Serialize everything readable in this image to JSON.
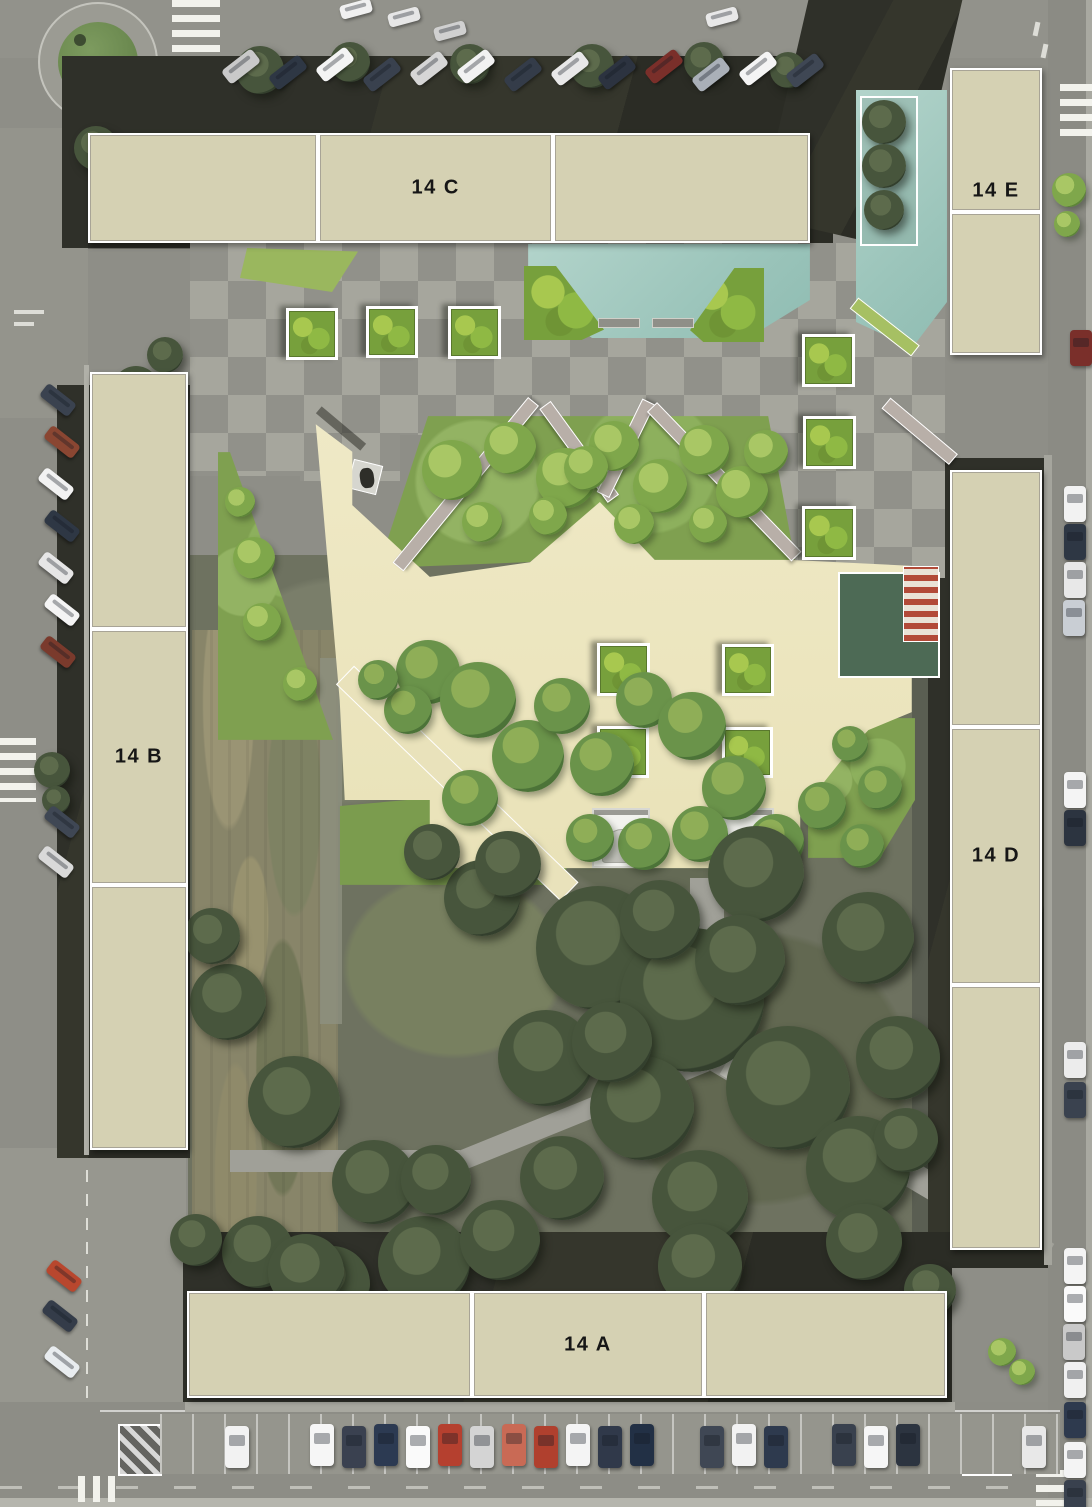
{
  "meta": {
    "canvas_width": 1092,
    "canvas_height": 1507
  },
  "palette": {
    "street": "#8e8e87",
    "roof_dark": "#32332b",
    "block_fill": "#d5d1b3",
    "block_border": "#ffffff",
    "block_label_color": "#161616",
    "plaza_cream": "#ece5bd",
    "pool_teal": "#a3cac1",
    "lawn_bright": "#85a453",
    "checker_light": "#a6a69d",
    "checker_dark": "#91918a",
    "pergola": "#b8afa8",
    "awning_red": "#b24a38",
    "flat_roof_green": "#4d6a55",
    "path_light": "#a0a098",
    "tree_dark": "#47553c",
    "white_structure": "#f2f2ee"
  },
  "buildings": [
    {
      "id": "14C",
      "label": "14 C",
      "x": 88,
      "y": 133,
      "w": 722,
      "h": 110,
      "orientation": "h",
      "dividers": [
        0.319,
        0.644
      ],
      "label_segment": 1
    },
    {
      "id": "14E",
      "label": "14 E",
      "x": 950,
      "y": 68,
      "w": 92,
      "h": 287,
      "orientation": "v",
      "dividers": [
        0.5
      ],
      "label_segment": 0,
      "label_pos": [
        0.5,
        0.43
      ]
    },
    {
      "id": "14B",
      "label": "14 B",
      "x": 90,
      "y": 372,
      "w": 98,
      "h": 778,
      "orientation": "v",
      "dividers": [
        0.33,
        0.66
      ],
      "label_segment": 1
    },
    {
      "id": "14D",
      "label": "14 D",
      "x": 950,
      "y": 470,
      "w": 92,
      "h": 780,
      "orientation": "v",
      "dividers": [
        0.33,
        0.66
      ],
      "label_segment": 1
    },
    {
      "id": "14A",
      "label": "14 A",
      "x": 187,
      "y": 1291,
      "w": 760,
      "h": 107,
      "orientation": "h",
      "dividers": [
        0.375,
        0.68
      ],
      "label_segment": 1
    }
  ],
  "planters": [
    [
      286,
      308,
      46
    ],
    [
      366,
      306,
      46
    ],
    [
      448,
      306,
      47
    ],
    [
      802,
      334,
      47
    ],
    [
      803,
      416,
      47
    ],
    [
      802,
      506,
      48
    ],
    [
      597,
      643,
      47
    ],
    [
      722,
      644,
      46
    ],
    [
      597,
      726,
      46
    ],
    [
      722,
      727,
      45
    ]
  ],
  "vegetation": {
    "bright": [
      [
        452,
        470,
        30
      ],
      [
        510,
        448,
        26
      ],
      [
        566,
        478,
        30
      ],
      [
        614,
        446,
        25
      ],
      [
        660,
        486,
        27
      ],
      [
        704,
        450,
        25
      ],
      [
        742,
        492,
        26
      ],
      [
        482,
        522,
        20
      ],
      [
        548,
        516,
        19
      ],
      [
        634,
        524,
        20
      ],
      [
        708,
        524,
        19
      ],
      [
        766,
        452,
        22
      ],
      [
        586,
        468,
        22
      ],
      [
        254,
        558,
        21
      ],
      [
        262,
        622,
        19
      ],
      [
        300,
        684,
        17
      ],
      [
        240,
        502,
        15
      ],
      [
        1002,
        1352,
        14
      ],
      [
        1022,
        1372,
        13
      ],
      [
        1069,
        190,
        17
      ],
      [
        1067,
        224,
        13
      ]
    ],
    "medium": [
      [
        428,
        672,
        32
      ],
      [
        478,
        700,
        38
      ],
      [
        528,
        756,
        36
      ],
      [
        470,
        798,
        28
      ],
      [
        562,
        706,
        28
      ],
      [
        602,
        764,
        32
      ],
      [
        644,
        700,
        28
      ],
      [
        692,
        726,
        34
      ],
      [
        734,
        788,
        32
      ],
      [
        776,
        842,
        28
      ],
      [
        644,
        844,
        26
      ],
      [
        700,
        834,
        28
      ],
      [
        590,
        838,
        24
      ],
      [
        822,
        806,
        24
      ],
      [
        862,
        846,
        22
      ],
      [
        880,
        788,
        22
      ],
      [
        850,
        744,
        18
      ],
      [
        408,
        710,
        24
      ],
      [
        378,
        680,
        20
      ]
    ],
    "dark": [
      [
        598,
        948,
        62
      ],
      [
        692,
        1000,
        72
      ],
      [
        788,
        1088,
        62
      ],
      [
        642,
        1108,
        52
      ],
      [
        868,
        938,
        46
      ],
      [
        756,
        874,
        48
      ],
      [
        546,
        1058,
        48
      ],
      [
        858,
        1168,
        52
      ],
      [
        700,
        1198,
        48
      ],
      [
        562,
        1178,
        42
      ],
      [
        482,
        898,
        38
      ],
      [
        898,
        1058,
        42
      ],
      [
        612,
        1042,
        40
      ],
      [
        740,
        960,
        45
      ],
      [
        660,
        920,
        40
      ],
      [
        228,
        1002,
        38
      ],
      [
        294,
        1102,
        46
      ],
      [
        374,
        1182,
        42
      ],
      [
        258,
        1252,
        36
      ],
      [
        424,
        1262,
        46
      ],
      [
        332,
        1284,
        38
      ],
      [
        212,
        936,
        28
      ],
      [
        436,
        1180,
        35
      ],
      [
        500,
        1240,
        40
      ],
      [
        196,
        1240,
        26
      ],
      [
        306,
        1272,
        38
      ],
      [
        700,
        1266,
        42
      ],
      [
        864,
        1242,
        38
      ],
      [
        930,
        1290,
        26
      ],
      [
        508,
        864,
        33
      ],
      [
        432,
        852,
        28
      ],
      [
        906,
        1140,
        32
      ],
      [
        884,
        122,
        22
      ],
      [
        884,
        166,
        22
      ],
      [
        884,
        210,
        20
      ],
      [
        136,
        390,
        24
      ],
      [
        150,
        448,
        22
      ],
      [
        132,
        500,
        19
      ],
      [
        165,
        355,
        18
      ],
      [
        52,
        770,
        18
      ],
      [
        56,
        800,
        14
      ],
      [
        260,
        70,
        24
      ],
      [
        350,
        62,
        20
      ],
      [
        470,
        64,
        20
      ],
      [
        592,
        66,
        22
      ],
      [
        704,
        62,
        20
      ],
      [
        788,
        70,
        18
      ],
      [
        96,
        148,
        22
      ],
      [
        150,
        190,
        18
      ]
    ]
  },
  "cars": {
    "top_angled": {
      "rot": -38,
      "w": 38,
      "h": 17,
      "items": [
        [
          222,
          58,
          "#c9c9c9"
        ],
        [
          269,
          64,
          "#2e3744"
        ],
        [
          316,
          56,
          "#f4f4f4"
        ],
        [
          363,
          66,
          "#39414e"
        ],
        [
          410,
          60,
          "#d6d6d6"
        ],
        [
          457,
          58,
          "#f2f2f2"
        ],
        [
          504,
          66,
          "#343c49"
        ],
        [
          551,
          60,
          "#e8e8e8"
        ],
        [
          598,
          64,
          "#2c3340"
        ],
        [
          645,
          58,
          "#7a2f2a"
        ],
        [
          692,
          66,
          "#aab0b8"
        ],
        [
          739,
          60,
          "#f4f4f4"
        ],
        [
          786,
          62,
          "#3f4754"
        ]
      ]
    },
    "top_edge": {
      "rot": -15,
      "w": 32,
      "h": 14,
      "items": [
        [
          340,
          2,
          "#f0f0f0"
        ],
        [
          388,
          10,
          "#e6e6e6"
        ],
        [
          434,
          24,
          "#d0d0d0"
        ],
        [
          706,
          10,
          "#e8e8e8"
        ]
      ]
    },
    "left_angled": {
      "rot": 38,
      "w": 36,
      "h": 16,
      "items": [
        [
          40,
          392,
          "#3a424f"
        ],
        [
          44,
          434,
          "#8a4632"
        ],
        [
          38,
          476,
          "#f2f2f2"
        ],
        [
          44,
          518,
          "#2e3744"
        ],
        [
          38,
          560,
          "#e6e6e6"
        ],
        [
          44,
          602,
          "#f4f4f4"
        ],
        [
          40,
          644,
          "#7a3a2c"
        ],
        [
          44,
          814,
          "#3f4754"
        ],
        [
          38,
          854,
          "#d9d9d9"
        ],
        [
          46,
          1268,
          "#b8472e"
        ],
        [
          42,
          1308,
          "#343c49"
        ],
        [
          44,
          1354,
          "#e8ecef"
        ]
      ]
    },
    "right_vertical": {
      "rot": 0,
      "w": 22,
      "h": 36,
      "items": [
        [
          1070,
          330,
          "#7a2f2a"
        ],
        [
          1064,
          486,
          "#f2f2f2"
        ],
        [
          1064,
          524,
          "#2e3744"
        ],
        [
          1064,
          562,
          "#e8e8e8"
        ],
        [
          1063,
          600,
          "#c9ced4"
        ],
        [
          1064,
          772,
          "#f4f4f4"
        ],
        [
          1064,
          810,
          "#2c3440"
        ],
        [
          1064,
          1042,
          "#ececec"
        ],
        [
          1064,
          1082,
          "#3a424f"
        ],
        [
          1064,
          1248,
          "#f4f4f4"
        ],
        [
          1064,
          1286,
          "#fafafa"
        ],
        [
          1063,
          1324,
          "#c9c9c9"
        ],
        [
          1064,
          1362,
          "#f0f0f0"
        ],
        [
          1064,
          1402,
          "#2e3a4e"
        ],
        [
          1064,
          1442,
          "#f4f4f4"
        ],
        [
          1064,
          1480,
          "#39414e"
        ]
      ]
    },
    "bottom_vertical": {
      "rot": 0,
      "w": 24,
      "h": 42,
      "items": [
        [
          225,
          1426,
          "#f2f2f2"
        ],
        [
          310,
          1424,
          "#f6f6f6"
        ],
        [
          342,
          1426,
          "#3a4150"
        ],
        [
          374,
          1424,
          "#2c3a52"
        ],
        [
          406,
          1426,
          "#fafafa"
        ],
        [
          438,
          1424,
          "#b5402f"
        ],
        [
          470,
          1426,
          "#d4d4d4"
        ],
        [
          502,
          1424,
          "#c96a55"
        ],
        [
          534,
          1426,
          "#b0402e"
        ],
        [
          566,
          1424,
          "#f4f4f4"
        ],
        [
          598,
          1426,
          "#30394a"
        ],
        [
          630,
          1424,
          "#223045"
        ],
        [
          700,
          1426,
          "#3f4754"
        ],
        [
          732,
          1424,
          "#f2f2f2"
        ],
        [
          764,
          1426,
          "#2e3a4e"
        ],
        [
          832,
          1424,
          "#39414e"
        ],
        [
          864,
          1426,
          "#f6f6f6"
        ],
        [
          896,
          1424,
          "#2c3440"
        ],
        [
          1022,
          1426,
          "#e8e8e8"
        ]
      ]
    }
  },
  "crosswalks": [
    {
      "x": 172,
      "y": 0,
      "w": 48,
      "h": 52,
      "dir": "h"
    },
    {
      "x": 820,
      "y": 2,
      "w": 46,
      "h": 44,
      "dir": "v"
    },
    {
      "x": 1060,
      "y": 84,
      "w": 32,
      "h": 54,
      "dir": "h"
    },
    {
      "x": 0,
      "y": 738,
      "w": 36,
      "h": 64,
      "dir": "h"
    },
    {
      "x": 78,
      "y": 1476,
      "w": 38,
      "h": 26,
      "dir": "v"
    },
    {
      "x": 1036,
      "y": 1470,
      "w": 30,
      "h": 36,
      "dir": "h"
    }
  ],
  "benches": [
    {
      "x": 598,
      "y": 318,
      "w": 40,
      "h": 8
    },
    {
      "x": 652,
      "y": 318,
      "w": 40,
      "h": 8
    },
    {
      "x": 672,
      "y": 890,
      "w": 9,
      "h": 16
    },
    {
      "x": 672,
      "y": 928,
      "w": 9,
      "h": 16
    },
    {
      "x": 672,
      "y": 966,
      "w": 9,
      "h": 16
    },
    {
      "x": 672,
      "y": 1004,
      "w": 9,
      "h": 16
    }
  ],
  "marked_bays": [
    {
      "x": 118,
      "y": 1424,
      "w": 40,
      "h": 48
    },
    {
      "x": 962,
      "y": 1424,
      "w": 46,
      "h": 48
    }
  ]
}
